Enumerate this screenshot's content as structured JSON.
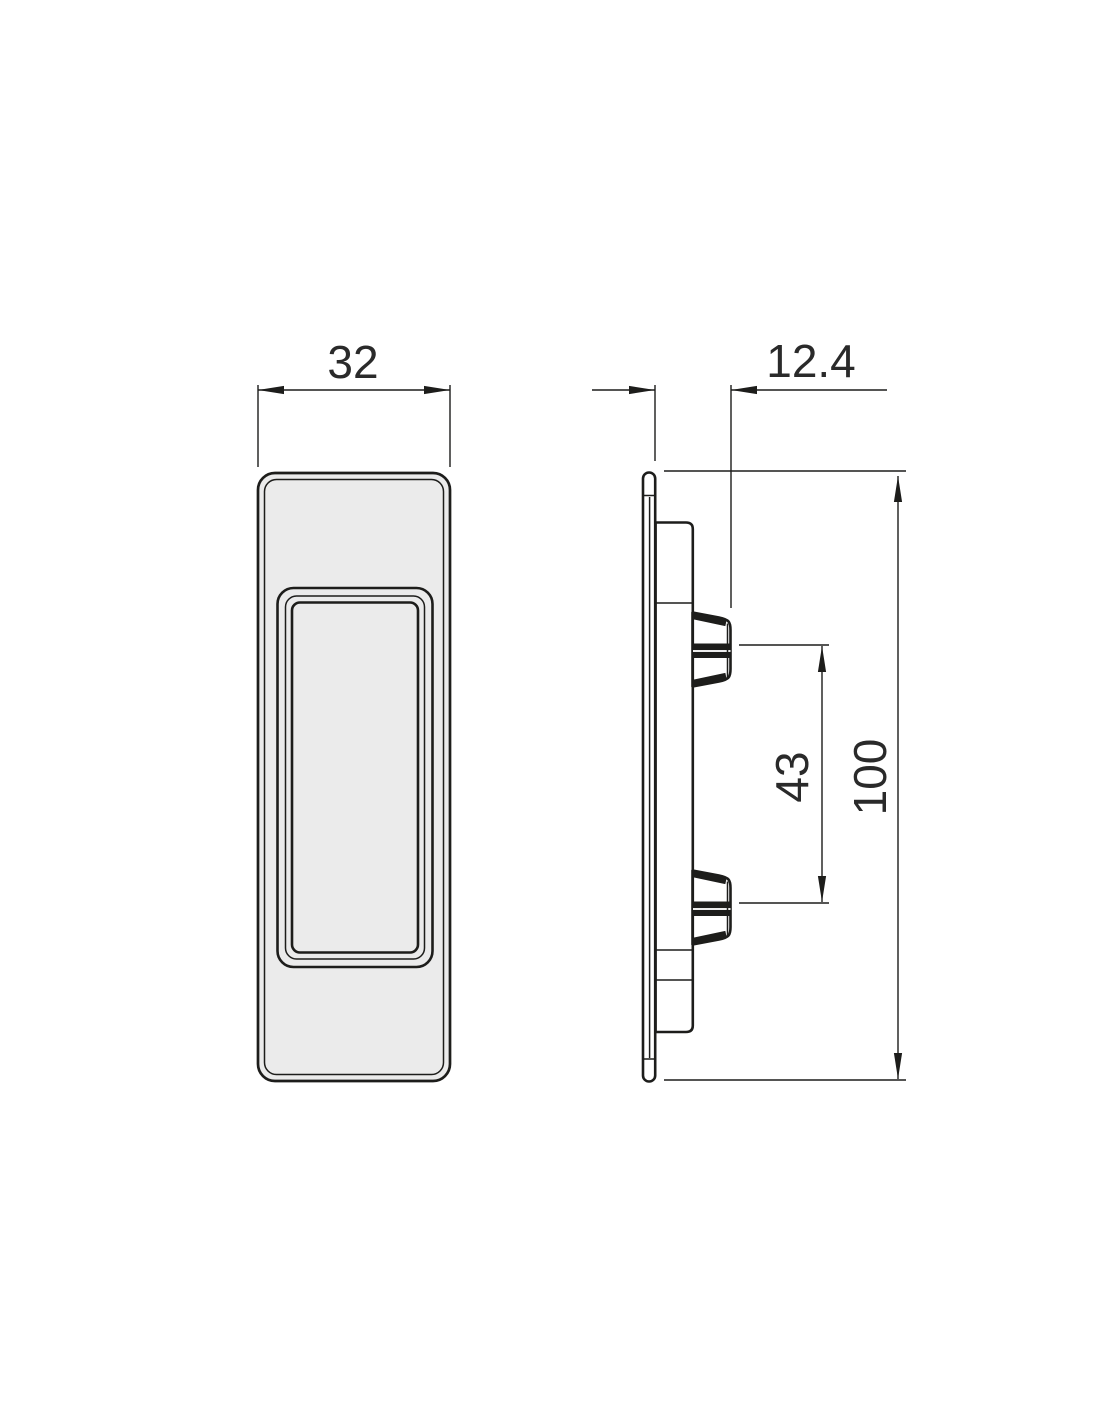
{
  "drawing": {
    "dims": {
      "width": "32",
      "depth": "12.4",
      "height": "100",
      "clip_spacing": "43"
    },
    "colors": {
      "line": "#1d1d1b",
      "text": "#2a2a2a",
      "fill_face": "#ebebeb",
      "fill_body": "#e6e6e6",
      "fill_flange": "#ffffff",
      "fill_clip": "#ededed",
      "background": "#ffffff"
    }
  }
}
